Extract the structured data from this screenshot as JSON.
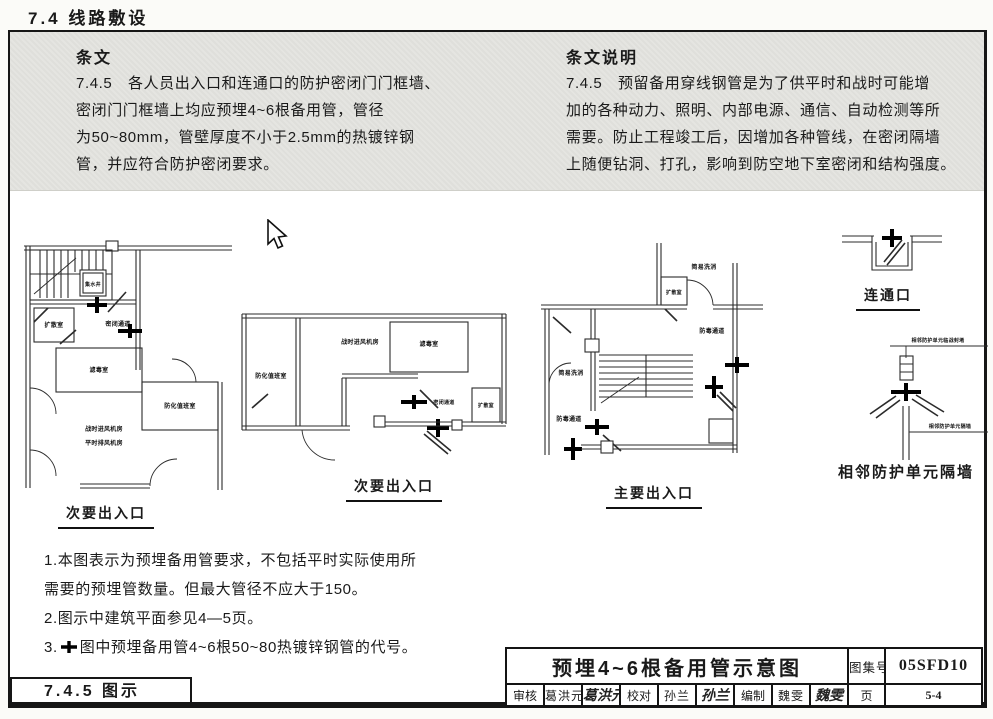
{
  "header": {
    "section": "7.4 线路敷设",
    "footer_tab": "7.4.5 图示"
  },
  "provisions": {
    "heading": "条文",
    "lines": [
      "7.4.5　各人员出入口和连通口的防护密闭门门框墙、",
      "密闭门门框墙上均应预埋4~6根备用管，管径",
      "为50~80mm，管壁厚度不小于2.5mm的热镀锌钢",
      "管，并应符合防护密闭要求。"
    ]
  },
  "commentary": {
    "heading": "条文说明",
    "lines": [
      "7.4.5　预留备用穿线钢管是为了供平时和战时可能增",
      "加的各种动力、照明、内部电源、通信、自动检测等所",
      "需要。防止工程竣工后，因增加各种管线，在密闭隔墙",
      "上随便钻洞、打孔，影响到防空地下室密闭和结构强度。"
    ]
  },
  "plans": {
    "plan1": {
      "caption": "次要出入口",
      "sump": "集水井",
      "diffusion": "扩散室",
      "sealed_passage": "密闭通道",
      "filter_room": "滤毒室",
      "duty_room": "防化值班室",
      "fan_room_line1": "战时进风机房",
      "fan_room_line2": "平时排风机房"
    },
    "plan2": {
      "caption": "次要出入口",
      "duty_room": "防化值班室",
      "fan_room": "战时进风机房",
      "filter_room": "滤毒室",
      "sealed_passage": "密闭通道",
      "diffusion": "扩散室"
    },
    "plan3": {
      "caption": "主要出入口",
      "wash_top": "简易洗消",
      "diffusion": "扩散室",
      "gas_passage_right": "防毒通道",
      "wash_left": "简易洗消",
      "gas_passage_left": "防毒通道"
    },
    "connector": {
      "caption": "连通口"
    },
    "unit_wall": {
      "caption": "相邻防护单元隔墙",
      "label_top": "相邻防护单元临战封堵",
      "label_bottom": "相邻防护单元隔墙"
    }
  },
  "notes": {
    "line1": "1.本图表示为预埋备用管要求，不包括平时实际使用所",
    "line2": "需要的预埋管数量。但最大管径不应大于150。",
    "line3": "2.图示中建筑平面参见4—5页。",
    "line4_prefix": "3.",
    "line4_text": "图中预埋备用管4~6根50~80热镀锌钢管的代号。"
  },
  "symbols": {
    "reserve_pipe_cross": "✚"
  },
  "title_block": {
    "title": "预埋4~6根备用管示意图",
    "atlas_label": "图集号",
    "atlas_no": "05SFD10",
    "page_label": "页",
    "page_no": "5-4",
    "reviewer_label": "审核",
    "reviewer_name": "葛洪元",
    "reviewer_signature": "葛洪元",
    "proofreader_label": "校对",
    "proofreader_name": "孙兰",
    "proofreader_signature": "孙兰",
    "compiler_label": "编制",
    "compiler_name": "魏雯",
    "compiler_signature": "魏雯"
  },
  "colors": {
    "band": "#e4e4e0",
    "ink": "#1a1a1a"
  }
}
